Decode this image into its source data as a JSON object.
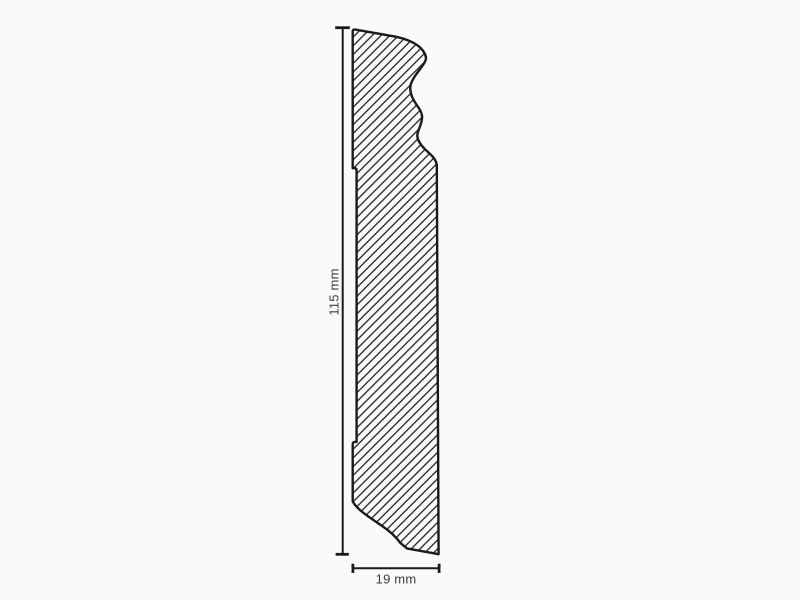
{
  "figure": {
    "kind": "skirting-board-profile-cross-section",
    "height_dimension": {
      "label": "115 mm",
      "value_mm": 115
    },
    "width_dimension": {
      "label": "19 mm",
      "value_mm": 19
    },
    "style": {
      "background": "#fafafa",
      "outline_color": "#1a1a1a",
      "hatch_color": "#222222",
      "hatch_pattern": "diagonal-45deg",
      "dimension_color": "#1a1a1a",
      "label_color": "#3c3c3c"
    }
  }
}
